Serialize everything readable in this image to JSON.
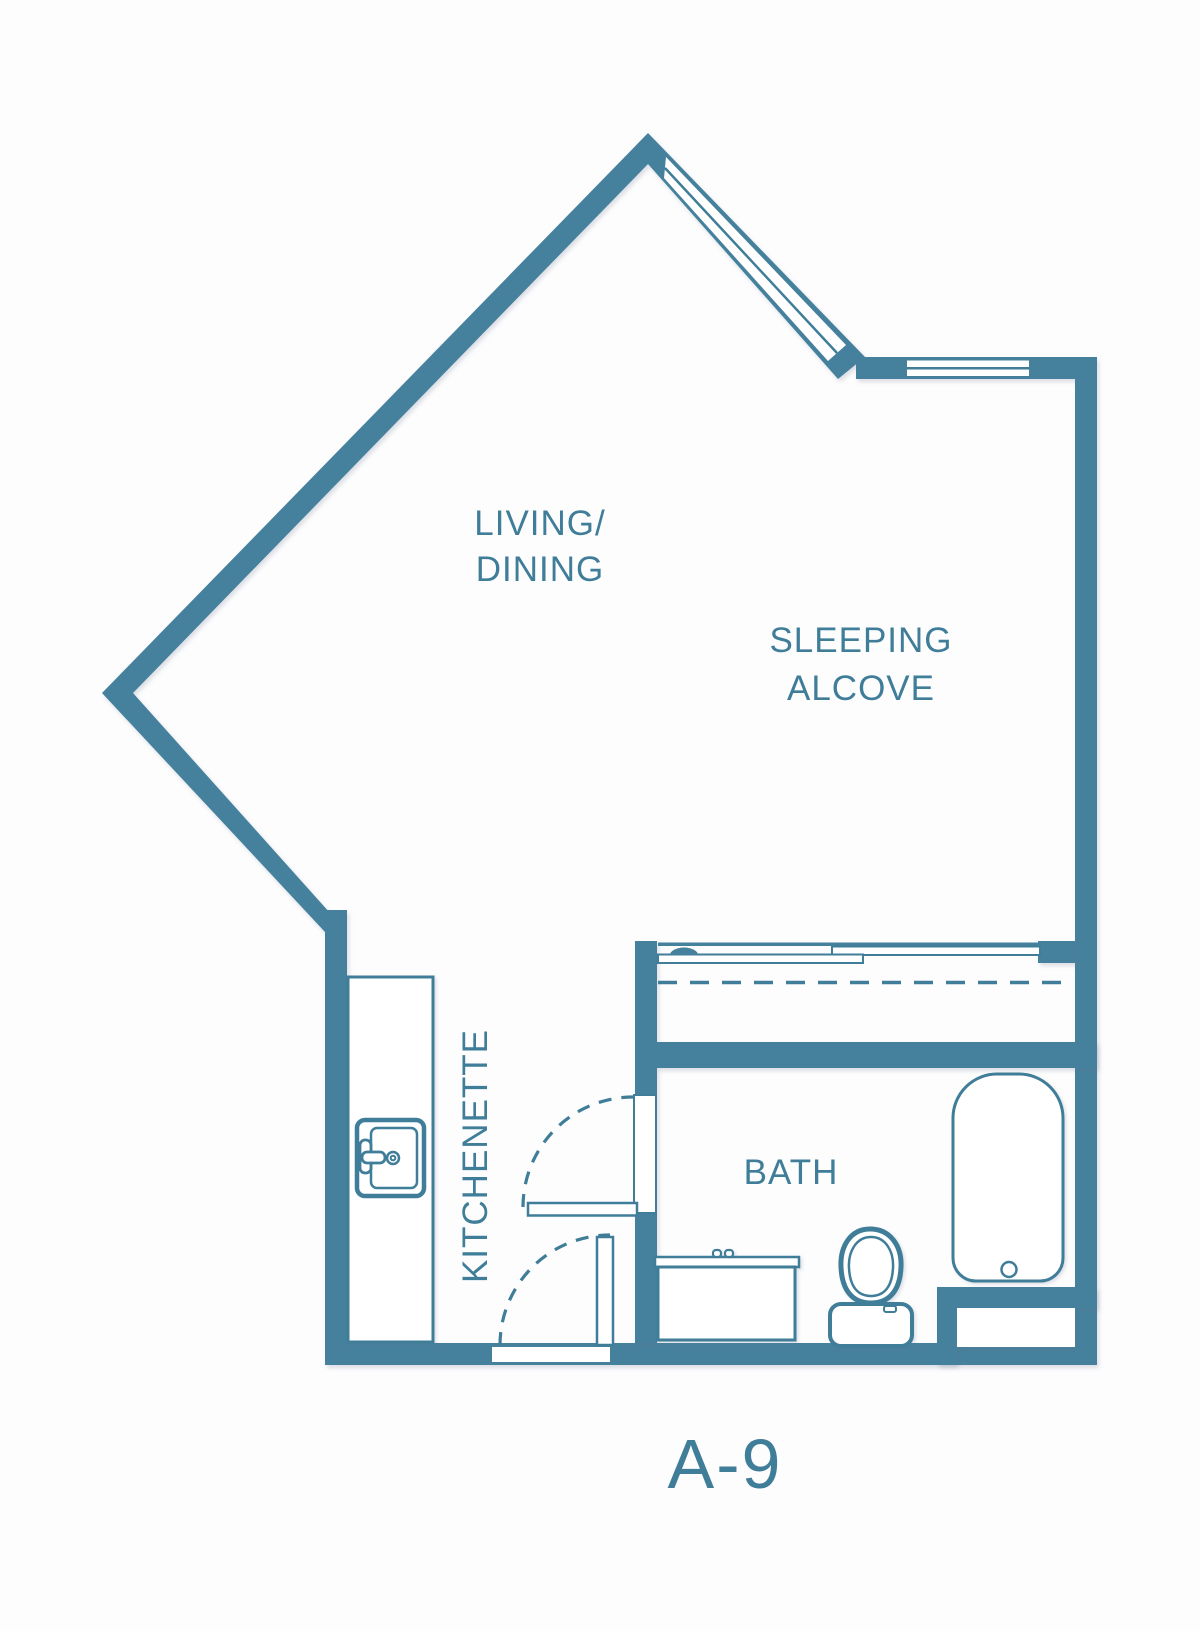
{
  "page": {
    "background": "#fdfdfe"
  },
  "colors": {
    "wall": "#45819d",
    "line": "#3f7d99",
    "text": "#3f7d99",
    "background": "#fdfdfe"
  },
  "plan": {
    "unit_label": "A-9",
    "rooms": [
      {
        "name": "living-dining",
        "lines": [
          "LIVING/",
          "DINING"
        ]
      },
      {
        "name": "sleeping-alcove",
        "lines": [
          "SLEEPING",
          "ALCOVE"
        ]
      },
      {
        "name": "kitchenette",
        "lines": [
          "KITCHENETTE"
        ]
      },
      {
        "name": "bath",
        "lines": [
          "BATH"
        ]
      }
    ],
    "fixtures": [
      "window-diagonal",
      "window-horizontal",
      "closet-sliding-doors",
      "closet-dashed-rod",
      "bath-door-swing",
      "entry-door-swing",
      "kitchenette-counter",
      "kitchen-sink",
      "vanity-sink",
      "toilet",
      "bathtub",
      "wall-niche"
    ]
  }
}
